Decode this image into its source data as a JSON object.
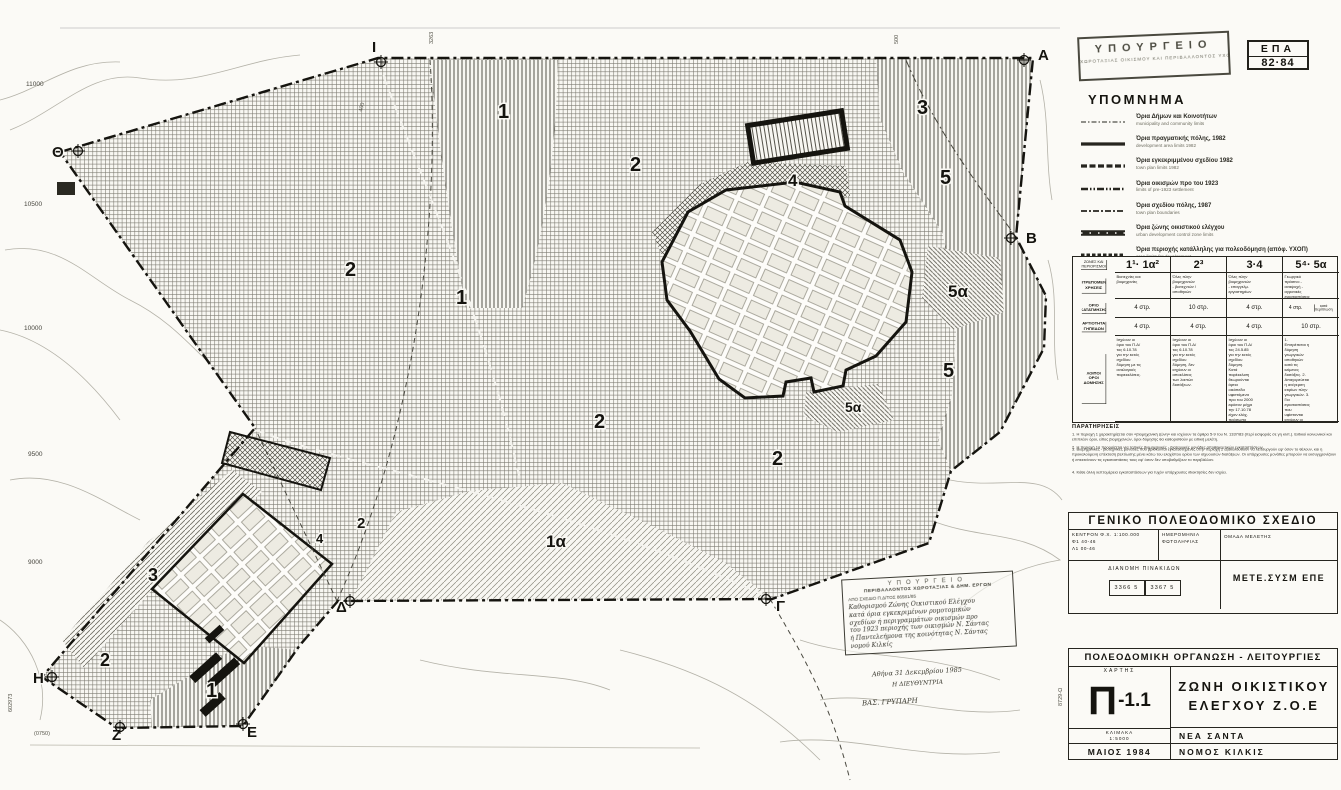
{
  "page": {
    "ministry_line1": "ΥΠΟΥΡΓΕΙΟ",
    "ministry_line2": "ΧΩΡΟΤΑΞΙΑΣ ΟΙΚΙΣΜΟΥ ΚΑΙ ΠΕΡΙΒΑΛΛΟΝΤΟΣ ΥΧΟΠ",
    "epa_line1": "ΕΠΑ",
    "epa_line2": "82·84"
  },
  "legend": {
    "title": "ΥΠΟΜΝΗΜΑ",
    "items": [
      {
        "symbol": "dashdot_thin",
        "gr": "Όρια Δήμων και Κοινοτήτων",
        "en": "municipality and community limits"
      },
      {
        "symbol": "solid_thick",
        "gr": "Όρια πραγματικής πόλης, 1982",
        "en": "development area limits 1982"
      },
      {
        "symbol": "dash_thick",
        "gr": "Όρια εγκεκριμμένου σχεδίου 1982",
        "en": "town plan limits 1982"
      },
      {
        "symbol": "dash_dotdot",
        "gr": "Όρια οικισμών προ του 1923",
        "en": "limits of pre-1923 settlement"
      },
      {
        "symbol": "dashdot_med",
        "gr": "Όρια σχεδίου πόλης, 1987",
        "en": "town plan boundaries"
      },
      {
        "symbol": "zoe",
        "gr": "Όρια ζώνης οικιστικού ελέγχου",
        "en": "urban development control zone limits"
      },
      {
        "symbol": "dash_dense",
        "gr": "Όρια περιοχής κατάλληλης για πολεοδόμηση (απόφ. ΥΧΟΠ)",
        "en": "area limits for development"
      },
      {
        "symbol": "circles",
        "gr": "Όρια ρέματος",
        "en": ""
      },
      {
        "symbol": "dash_bold",
        "gr": "Όρια πάρκων βιομηχανίας",
        "en": ""
      }
    ]
  },
  "zones_table": {
    "corner": "ΖΩΝΕΣ ΚΑΙ ΠΕΡΙΟΡΙΣΜΟΙ",
    "columns": [
      "1¹· 1α²",
      "2³",
      "3·4",
      "5⁴· 5α"
    ],
    "rows": [
      {
        "label": "ΕΠΙΤΡΕΠΟΜΕΝΕΣ ΧΡΗΣΕΙΣ",
        "type": "text",
        "cells": [
          "Βιοτεχνίες και βιομηχανίες",
          "Όλες πλην βιομηχανιών - βιοτεχνιών / αποθηκών",
          "Όλες πλην βιομηχανιών - επαγγελμ. εργαστηρίων",
          "Γεωργικό πράσινο - αναψυχή - αγροτικές εγκαταστάσεις"
        ]
      },
      {
        "label": "ΟΡΙΟ ΚΑΤΑΤΜΗΣΗΣ",
        "type": "val",
        "cells": [
          "4 στρ.",
          "10 στρ.",
          "4 στρ.",
          "4 στρ.¦κατά περίπτωση"
        ]
      },
      {
        "label": "ΑΡΤΙΟΤΗΤΑ ΓΗΠΕΔΩΝ",
        "type": "val",
        "cells": [
          "4 στρ.",
          "4 στρ.",
          "4 στρ.",
          "10 στρ."
        ]
      },
      {
        "label": "ΛΟΙΠΟΙ ΟΡΟΙ ΔΟΜΗΣΗΣ",
        "type": "long",
        "cells": [
          "Ισχύουν οι όροι του Π.Δ/τος 6.10.78 για την εκτός σχεδίου δόμηση με τις αναλογικές παρεκκλίσεις.",
          "Ισχύουν οι όροι του Π.Δ/τος 6.10.78 για την εκτός σχεδίου δόμηση, δεν ισχύουν οι αποκλίσεις των λοιπών διατάξεων.",
          "Ισχύουν οι όροι του Π.Δ/τος 24.5.85 για την εκτός σχεδίου δόμηση. Κατά παρέκκλιση θεωρούνται άρτια οικόπεδα υφιστάμενα προ του 2000 εφόσον μέχρι την 17.10.78 είχαν ελάχ. πρόσωπο 25μ. και ελάχ. βάθος 40μ.",
          "1. Επιτρέπεται η δόμηση γεωργικών αποθηκών κατά τις κείμενες διατάξεις. 2. Απαγορεύεται η ανέγερση κτιρίων πλην γεωργικών. 3. Για εγκαταστάσεις που υφίστανται ισχύουν οι κείμενες διατάξεις."
        ]
      }
    ]
  },
  "notes": {
    "title": "ΠΑΡΑΤΗΡΗΣΕΙΣ",
    "items": [
      "Η περιοχή 1 χαρακτηρίζεται σαν «βιομηχανική ζώνη» και ισχύουν τα άρθρα 5-9 του Ν. 1337/83 (περί εισφοράς σε γη κλπ.). Ειδικοί κοινωνικοί και επιπλέον όροι, είδος βιομηχανιών, όροι δόμησης θα καθορισθούν με ειδική μελέτη.",
      "Η περιοχή 1α προορίζεται για τοπικές βιομηχανικές - βιοτεχνικές μονάδες αποθηκευτικών εγκαταστάσεων.",
      "Βιομηχανικές - βιοτεχνικές μονάδες που βρίσκονται εγκατεστημένες στην περιοχή 2 εξακολουθούν να λειτουργούν εφ' όσον το θέλουν, και η προκαλούμενη επέκταση βελτίωσης μένει κάτω του ελαχίστου ορίου των ισχυουσών διατάξεων. Οι υπάρχουσες μονάδες μπορούν να εκσυγχρονίζουν ή επεκτείνουν τις εγκαταστάσεις τους εφ' όσον δεν υποβαθμίζουν το περιβάλλον.",
      "Κάθε άλλη λεπτομέρεια εγκαταστάσεων για τυχόν υπάρχουσες ιδιοκτησίες δεν ισχύει."
    ]
  },
  "gps_block": {
    "title": "ΓΕΝΙΚΟ ΠΟΛΕΟΔΟΜΙΚΟ ΣΧΕΔΙΟ",
    "center_line1": "ΚΕΝΤΡΟΝ Φ.Χ. 1:100.000",
    "center_line2": "Φ1 40-46",
    "center_line3": "Λ1 00-46",
    "photo": "ΗΜΕΡΟΜΗΝΙΑ ΦΩΤΟΛΗΨΙΑΣ",
    "team": "ΟΜΑΔΑ ΜΕΛΕΤΗΣ",
    "sheets_label": "ΔΙΑΝΟΜΗ ΠΙΝΑΚΙΔΩΝ",
    "sheet1": "3366 5",
    "sheet2": "3367 5",
    "firm": "ΜΕΤΕ.ΣΥΣΜ ΕΠΕ"
  },
  "title_block": {
    "bar": "ΠΟΛΕΟΔΟΜΙΚΗ ΟΡΓΑΝΩΣΗ - ΛΕΙΤΟΥΡΓΙΕΣ",
    "map_label": "ΧΑΡΤΗΣ",
    "map_code_big": "Π",
    "map_code_small": "-1.1",
    "scale_label": "ΚΛΙΜΑΚΑ",
    "scale_value": "1:5000",
    "date": "ΜΑΙΟΣ 1984",
    "zone_line1": "ΖΩΝΗ ΟΙΚΙΣΤΙΚΟΥ",
    "zone_line2": "ΕΛΕΓΧΟΥ  Ζ.Ο.Ε",
    "place": "ΝΕΑ ΣΑΝΤΑ",
    "prefecture": "ΝΟΜΟΣ ΚΙΛΚΙΣ",
    "side_code": "8729-Ω"
  },
  "decree_stamp": {
    "line1": "ΥΠΟΥΡΓΕΙΟ",
    "line2": "ΠΕΡΙΒΑΛΛΟΝΤΟΣ ΧΩΡΟΤΑΞΙΑΣ & ΔΗΜ. ΕΡΓΩΝ",
    "line3": "ΑΠΟ ΣΧΕΔΙΟ Π.Δ/ΤΟΣ 86581/85",
    "hand": [
      "Καθορισμού Ζώνης Οικιστικού Ελέγχου",
      "κατά όρια εγκεκριμένων ρυμοτομικών",
      "σχεδίων ή περιγραμμάτων οικισμών προ",
      "του 1923 περιοχής των οικισμών Ν. Σάντας",
      "ή Παντελεήμονα της κοινότητας Ν. Σάντας",
      "νομού Κιλκίς"
    ],
    "date_line": "Αθήνα 31 Δεκεμβρίου 1985",
    "sig_role": "Η ΔΙΕΥΘΥΝΤΡΙΑ",
    "sig_name": "ΒΑΣ. ΓΡΥΠΑΡΗ"
  },
  "map": {
    "zone_labels": [
      {
        "t": "1",
        "x": 498,
        "y": 118,
        "s": 20
      },
      {
        "t": "2",
        "x": 630,
        "y": 171,
        "s": 20
      },
      {
        "t": "3",
        "x": 917,
        "y": 114,
        "s": 20
      },
      {
        "t": "4",
        "x": 788,
        "y": 186,
        "s": 17
      },
      {
        "t": "5",
        "x": 940,
        "y": 184,
        "s": 20
      },
      {
        "t": "2",
        "x": 345,
        "y": 276,
        "s": 20
      },
      {
        "t": "1",
        "x": 456,
        "y": 304,
        "s": 20
      },
      {
        "t": "5α",
        "x": 948,
        "y": 297,
        "s": 17
      },
      {
        "t": "5",
        "x": 943,
        "y": 377,
        "s": 20
      },
      {
        "t": "5α",
        "x": 845,
        "y": 412,
        "s": 14
      },
      {
        "t": "2",
        "x": 594,
        "y": 428,
        "s": 20
      },
      {
        "t": "2",
        "x": 772,
        "y": 465,
        "s": 20
      },
      {
        "t": "1α",
        "x": 546,
        "y": 547,
        "s": 17
      },
      {
        "t": "2",
        "x": 357,
        "y": 528,
        "s": 15
      },
      {
        "t": "4",
        "x": 316,
        "y": 543,
        "s": 13
      },
      {
        "t": "3",
        "x": 148,
        "y": 581,
        "s": 18
      },
      {
        "t": "2",
        "x": 100,
        "y": 666,
        "s": 18
      },
      {
        "t": "1",
        "x": 206,
        "y": 697,
        "s": 20
      }
    ],
    "corner_letters": [
      {
        "t": "Θ",
        "x": 52,
        "y": 157,
        "mx": 78,
        "my": 151
      },
      {
        "t": "Ι",
        "x": 372,
        "y": 52,
        "mx": 381,
        "my": 62
      },
      {
        "t": "Α",
        "x": 1038,
        "y": 60,
        "mx": 1024,
        "my": 60
      },
      {
        "t": "Β",
        "x": 1026,
        "y": 243,
        "mx": 1011,
        "my": 238
      },
      {
        "t": "Γ",
        "x": 776,
        "y": 611,
        "mx": 766,
        "my": 599
      },
      {
        "t": "Δ",
        "x": 336,
        "y": 612,
        "mx": 350,
        "my": 601
      },
      {
        "t": "Ε",
        "x": 247,
        "y": 737,
        "mx": 243,
        "my": 724
      },
      {
        "t": "Ζ",
        "x": 112,
        "y": 740,
        "mx": 120,
        "my": 727
      },
      {
        "t": "Η",
        "x": 33,
        "y": 683,
        "mx": 52,
        "my": 677
      }
    ],
    "grid_labels": [
      {
        "t": "11000",
        "x": 26,
        "y": 86
      },
      {
        "t": "10500",
        "x": 24,
        "y": 206
      },
      {
        "t": "10000",
        "x": 24,
        "y": 330
      },
      {
        "t": "9500",
        "x": 28,
        "y": 456
      },
      {
        "t": "9000",
        "x": 28,
        "y": 564
      }
    ],
    "misc_labels": [
      {
        "t": "3263",
        "x": 433,
        "y": 44,
        "r": -90
      },
      {
        "t": "500",
        "x": 898,
        "y": 44,
        "r": -90
      },
      {
        "t": "1005",
        "x": 1106,
        "y": 42,
        "r": -90
      },
      {
        "t": "3293",
        "x": 1121,
        "y": 42,
        "r": -90
      },
      {
        "t": "400",
        "x": 362,
        "y": 112,
        "r": -75
      },
      {
        "t": "(0750)",
        "x": 34,
        "y": 735,
        "r": 0
      },
      {
        "t": "602973",
        "x": 12,
        "y": 712,
        "r": -90
      },
      {
        "t": "8729-Ω",
        "x": 1062,
        "y": 706,
        "r": -90
      }
    ]
  }
}
